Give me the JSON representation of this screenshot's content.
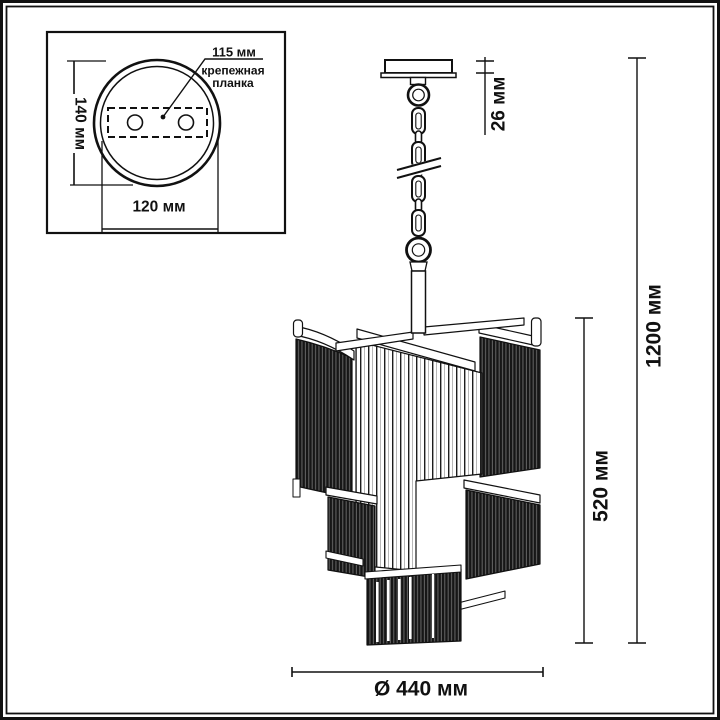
{
  "colors": {
    "ink": "#111111",
    "paper": "#ffffff"
  },
  "inset": {
    "dim_plate_length": "115 мм",
    "plate_label_line1": "крепежная",
    "plate_label_line2": "планка",
    "dim_canopy_height": "140 мм",
    "dim_plate_span": "120 мм"
  },
  "dimensions": {
    "canopy_height": "26 мм",
    "overall_height": "1200 мм",
    "shade_height": "520 мм",
    "diameter": "Ø 440 мм"
  }
}
